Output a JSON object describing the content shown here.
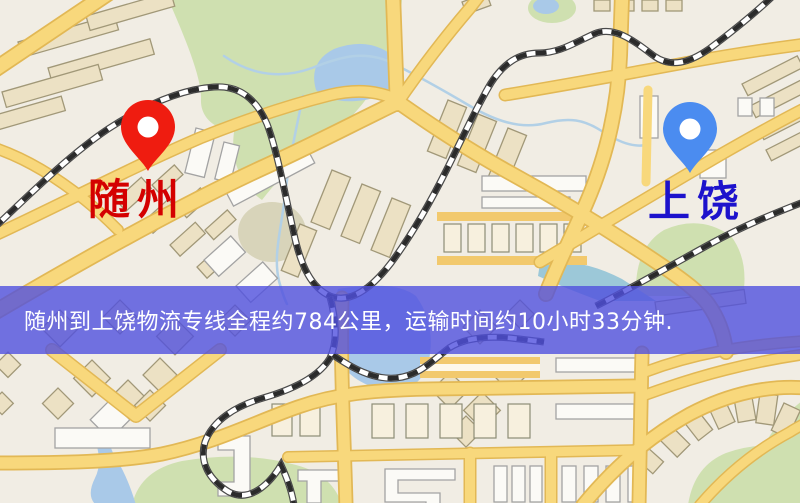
{
  "map": {
    "origin": {
      "label": "随州",
      "marker_color": "#ef1c10",
      "label_color": "#d40000"
    },
    "destination": {
      "label": "上饶",
      "marker_color": "#4b8cf0",
      "label_color": "#1d12cc"
    },
    "banner": {
      "text": "随州到上饶物流专线全程约784公里，运输时间约10小时33分钟.",
      "background_color": "#5050de",
      "text_color": "#ffffff"
    },
    "map_colors": {
      "background": "#f1ede4",
      "road": "#f8d87c",
      "road_casing": "#e2b855",
      "park": "#cfe0b0",
      "water": "#a9c9e8",
      "railway": "#2b2b2b"
    }
  }
}
